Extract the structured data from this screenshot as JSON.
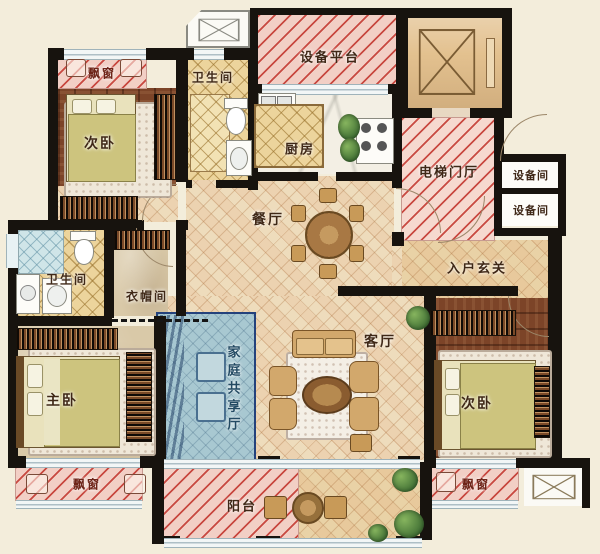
{
  "rooms": [
    {
      "id": "bay-window-top-left",
      "label": "飘窗"
    },
    {
      "id": "bathroom-top",
      "label": "卫生间"
    },
    {
      "id": "equipment-platform",
      "label": "设备平台"
    },
    {
      "id": "bedroom-secondary-top-left",
      "label": "次卧"
    },
    {
      "id": "kitchen",
      "label": "厨房"
    },
    {
      "id": "elevator-hall",
      "label": "电梯门厅"
    },
    {
      "id": "equipment-room-upper",
      "label": "设备间"
    },
    {
      "id": "equipment-room-lower",
      "label": "设备间"
    },
    {
      "id": "dining-room",
      "label": "餐厅"
    },
    {
      "id": "entry-foyer",
      "label": "入户玄关"
    },
    {
      "id": "bathroom-left",
      "label": "卫生间"
    },
    {
      "id": "cloakroom",
      "label": "衣帽间"
    },
    {
      "id": "family-shared-hall",
      "label": "家庭共享厅"
    },
    {
      "id": "living-room",
      "label": "客厅"
    },
    {
      "id": "master-bedroom",
      "label": "主卧"
    },
    {
      "id": "bedroom-secondary-bottom-right",
      "label": "次卧"
    },
    {
      "id": "bay-window-bottom-left",
      "label": "飘窗"
    },
    {
      "id": "balcony",
      "label": "阳台"
    },
    {
      "id": "bay-window-bottom-right",
      "label": "飘窗"
    }
  ],
  "colors": {
    "background": "#f3eddb",
    "wall": "#17130e",
    "bay_fill": "#f2cfc5",
    "bay_stripe": "#c43a32",
    "tile": "#eedcbc",
    "wood": "#7c4428",
    "gold_tile": "#ecd49c",
    "family_hall_fill": "#a8c8d1",
    "family_hall_border": "#24427c",
    "elevator_cab": "#e3c18f",
    "label_text": "#3f2817"
  }
}
